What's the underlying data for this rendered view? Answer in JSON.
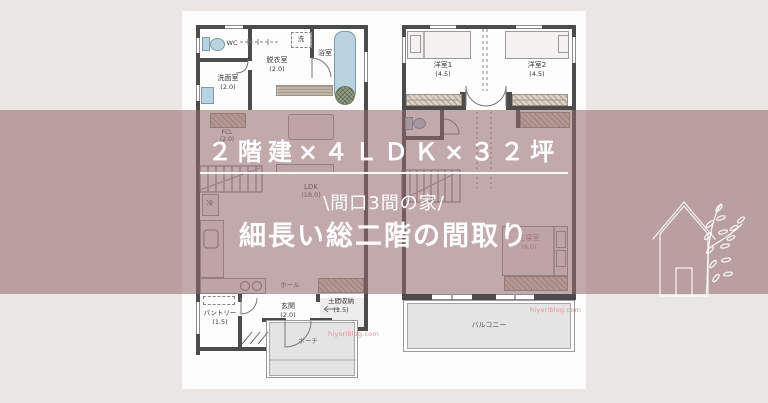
{
  "banner": {
    "title": "２階建×４ＬＤＫ×３２坪",
    "tagline": "\\間口3間の家/",
    "heading": "細長い総二階の間取り"
  },
  "floor1": {
    "wc": "WC",
    "washroom": "洗面室",
    "washroom_size": "(2.0)",
    "datsui": "脱衣室",
    "datsui_size": "(2.0)",
    "bath": "浴室",
    "washer": "洗",
    "fcl": "FCL",
    "fcl_size": "(2.0)",
    "ldk": "LDK",
    "ldk_size": "(18.0)",
    "fridge": "冷",
    "hall": "ホール",
    "pantry": "パントリー",
    "pantry_size": "(1.5)",
    "genkan": "玄関",
    "genkan_size": "(2.0)",
    "doma": "土間収納",
    "doma_size": "(1.5)",
    "porch": "ポーチ",
    "watermark": "hiyoriblog.com"
  },
  "floor2": {
    "room1": "洋室1",
    "room1_size": "(4.5)",
    "room2": "洋室2",
    "room2_size": "(4.5)",
    "master": "主寝室",
    "master_size": "(8.0)",
    "balcony": "バルコニー",
    "watermark": "hiyoriblog.com"
  }
}
